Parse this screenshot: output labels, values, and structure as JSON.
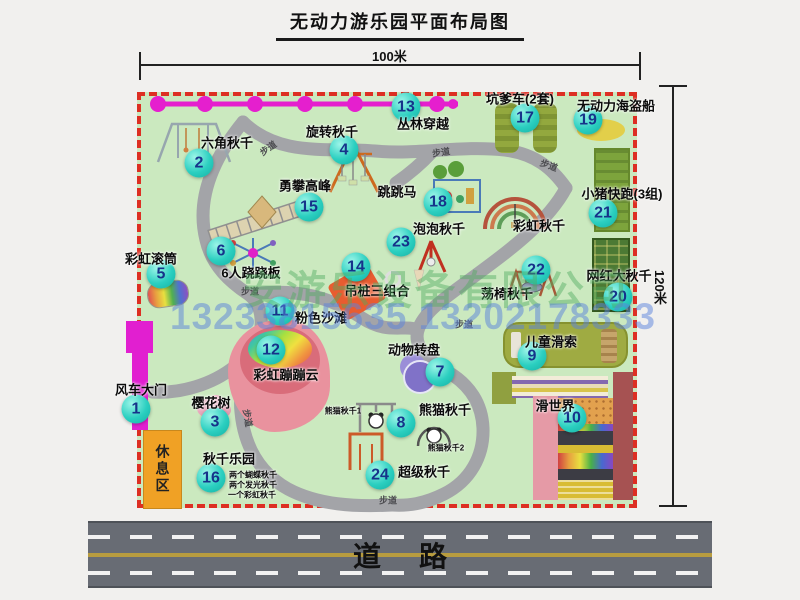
{
  "title": {
    "text": "无动力游乐园平面布局图"
  },
  "dimensions": {
    "width_label": "100米",
    "height_label": "120米"
  },
  "road": {
    "label": "道路"
  },
  "watermark": {
    "company": "安游乐设备有限公司",
    "phones": "13233815635 13202178333"
  },
  "colors": {
    "map_green": "#cbe9bf",
    "border_red": "#dd2f23",
    "badge_teal": "#2bcfc0",
    "gate_magenta": "#e11fd0",
    "road_gray": "#686c74",
    "rest_orange": "#f0a125"
  },
  "map": {
    "rest_area_label": "休息区",
    "path_labels": {
      "text": "步道",
      "positions": [
        [
          268,
          148,
          -35
        ],
        [
          441,
          152,
          -8
        ],
        [
          549,
          165,
          20
        ],
        [
          250,
          291,
          0
        ],
        [
          248,
          418,
          80
        ],
        [
          388,
          500,
          0
        ],
        [
          464,
          324,
          0
        ]
      ]
    },
    "items": [
      {
        "num": 1,
        "label": "风车大门",
        "badge": [
          136,
          409
        ],
        "label_pos": [
          141,
          389
        ]
      },
      {
        "num": 2,
        "label": "六角秋千",
        "badge": [
          199,
          163
        ],
        "label_pos": [
          227,
          142
        ]
      },
      {
        "num": 3,
        "label": "樱花树",
        "badge": [
          215,
          422
        ],
        "label_pos": [
          211,
          402
        ]
      },
      {
        "num": 4,
        "label": "旋转秋千",
        "badge": [
          344,
          150
        ],
        "label_pos": [
          332,
          131
        ]
      },
      {
        "num": 5,
        "label": "彩虹滚筒",
        "badge": [
          161,
          274
        ],
        "label_pos": [
          151,
          258
        ]
      },
      {
        "num": 6,
        "label": "6人跷跷板",
        "badge": [
          221,
          251
        ],
        "label_pos": [
          251,
          272
        ]
      },
      {
        "num": 7,
        "label": "动物转盘",
        "badge": [
          440,
          372
        ],
        "label_pos": [
          414,
          349
        ]
      },
      {
        "num": 8,
        "label": "熊猫秋千",
        "badge": [
          401,
          423
        ],
        "label_pos": [
          445,
          409
        ]
      },
      {
        "num": 9,
        "label": "儿童滑索",
        "badge": [
          532,
          356
        ],
        "label_pos": [
          551,
          341
        ]
      },
      {
        "num": 10,
        "label": "滑世界",
        "badge": [
          572,
          418
        ],
        "label_pos": [
          555,
          405
        ]
      },
      {
        "num": 11,
        "label": "粉色沙滩",
        "badge": [
          280,
          311
        ],
        "label_pos": [
          321,
          317
        ]
      },
      {
        "num": 12,
        "label": "彩虹蹦蹦云",
        "badge": [
          271,
          350
        ],
        "label_pos": [
          286,
          374
        ]
      },
      {
        "num": 13,
        "label": "丛林穿越",
        "badge": [
          406,
          107
        ],
        "label_pos": [
          423,
          123
        ]
      },
      {
        "num": 14,
        "label": "吊桩三组合",
        "badge": [
          356,
          267
        ],
        "label_pos": [
          377,
          290
        ]
      },
      {
        "num": 15,
        "label": "勇攀高峰",
        "badge": [
          309,
          207
        ],
        "label_pos": [
          305,
          185
        ]
      },
      {
        "num": 16,
        "label": "秋千乐园",
        "badge": [
          211,
          478
        ],
        "label_pos": [
          229,
          458
        ]
      },
      {
        "num": 17,
        "label": "坑爹车(2套)",
        "badge": [
          525,
          118
        ],
        "label_pos": [
          520,
          98
        ]
      },
      {
        "num": 18,
        "label": "跳跳马",
        "badge": [
          438,
          202
        ],
        "label_pos": [
          397,
          191
        ]
      },
      {
        "num": 19,
        "label": "无动力海盗船",
        "badge": [
          588,
          120
        ],
        "label_pos": [
          616,
          105
        ]
      },
      {
        "num": 20,
        "label": "网红大秋千",
        "badge": [
          618,
          297
        ],
        "label_pos": [
          619,
          275
        ]
      },
      {
        "num": 21,
        "label": "小猪快跑(3组)",
        "badge": [
          603,
          213
        ],
        "label_pos": [
          622,
          193
        ]
      },
      {
        "num": 22,
        "label": "荡椅秋千",
        "badge": [
          536,
          270
        ],
        "label_pos": [
          507,
          293
        ]
      },
      {
        "num": 23,
        "label": "泡泡秋千",
        "badge": [
          401,
          242
        ],
        "label_pos": [
          439,
          228
        ]
      },
      {
        "num": 24,
        "label": "超级秋千",
        "badge": [
          380,
          475
        ],
        "label_pos": [
          424,
          471
        ]
      }
    ],
    "extra_labels": [
      {
        "text": "彩虹秋千",
        "pos": [
          539,
          225
        ],
        "small": false
      },
      {
        "text": "熊猫秋千1",
        "pos": [
          343,
          411
        ],
        "small": true
      },
      {
        "text": "熊猫秋千2",
        "pos": [
          446,
          448
        ],
        "small": true
      },
      {
        "text": "两个蝴蝶秋千",
        "pos": [
          253,
          475
        ],
        "small": true
      },
      {
        "text": "两个发光秋千",
        "pos": [
          253,
          485
        ],
        "small": true
      },
      {
        "text": "一个彩虹秋千",
        "pos": [
          252,
          495
        ],
        "small": true
      }
    ]
  }
}
